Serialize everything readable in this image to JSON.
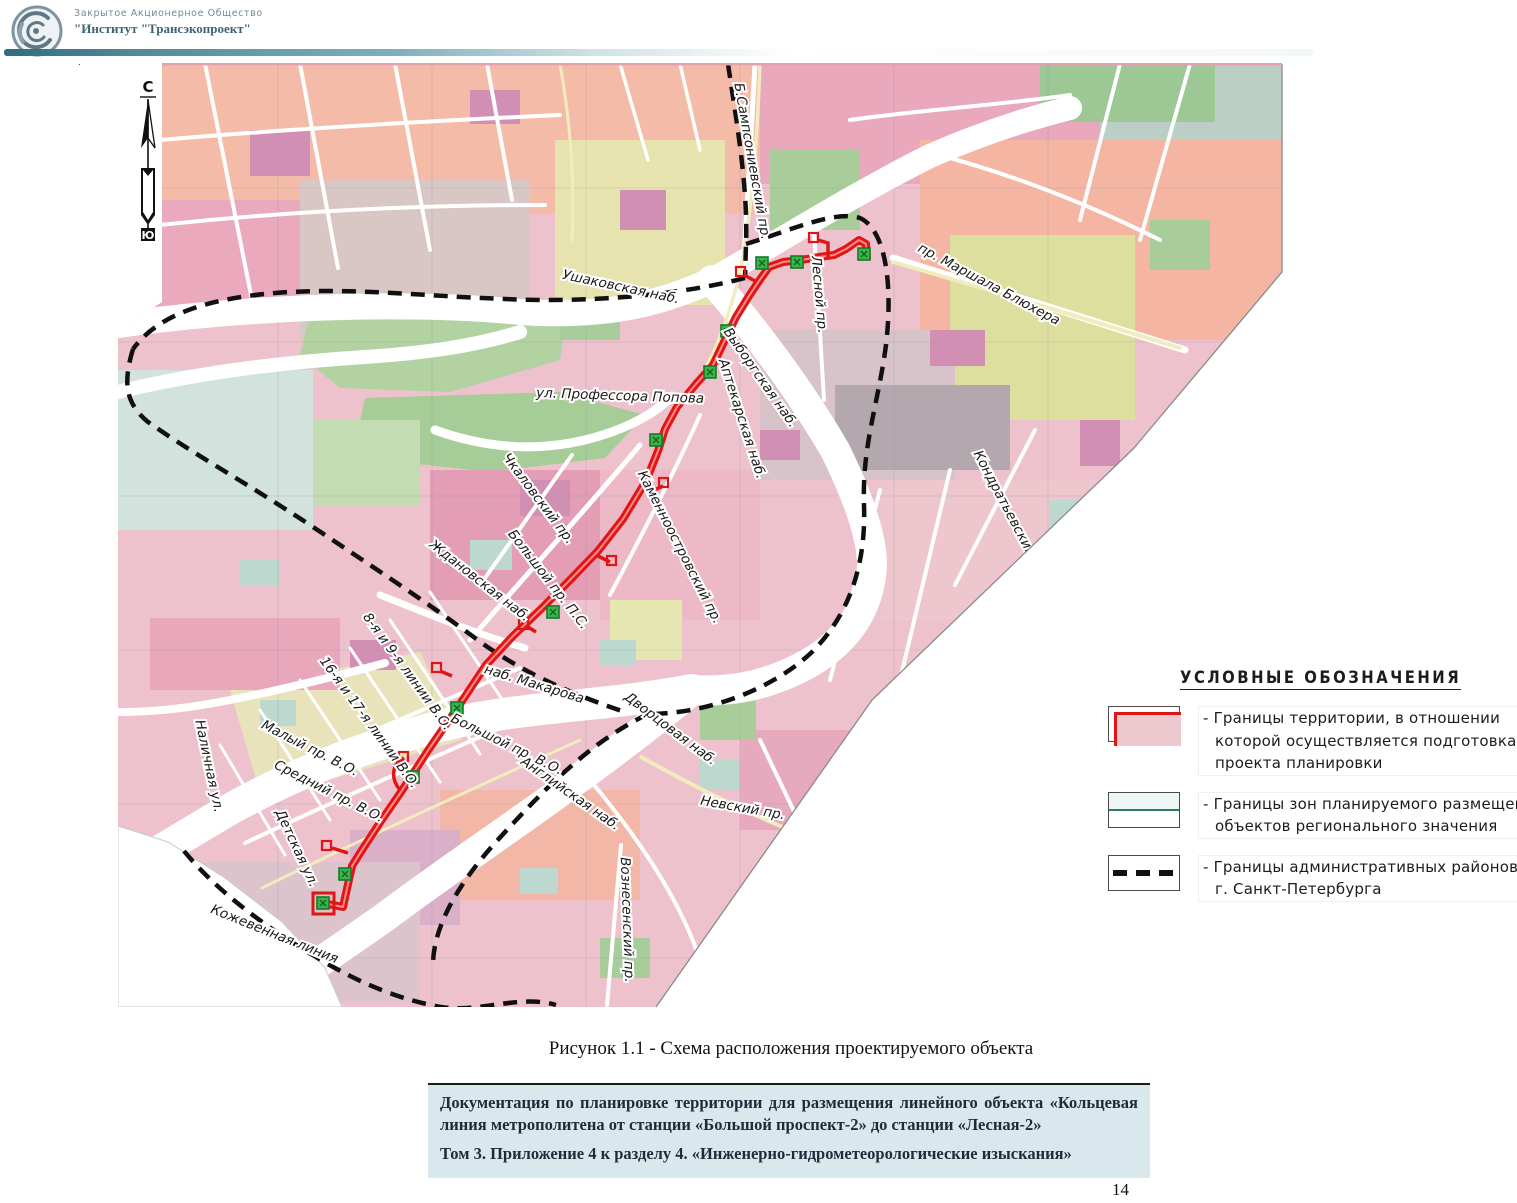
{
  "header": {
    "org_line1": "Закрытое Акционерное Общество",
    "org_line2": "\"Институт \"Трансэкопроект\"",
    "accent_color": "#4f8b99"
  },
  "page": {
    "number": "14",
    "background": "#ffffff"
  },
  "figure": {
    "caption": "Рисунок 1.1 - Схема расположения проектируемого объекта"
  },
  "footer_box": {
    "line1": "Документация по планировке территории для размещения линейного объекта «Кольцевая линия метрополитена от станции «Большой проспект-2» до станции «Лесная-2»",
    "line2": "Том 3. Приложение 4 к разделу 4. «Инженерно-гидрометеорологические изыскания»"
  },
  "legend": {
    "title": "УСЛОВНЫЕ ОБОЗНАЧЕНИЯ",
    "items": [
      {
        "swatch": "area-red",
        "lines": [
          "- Границы территории, в отношении",
          "которой осуществляется подготовка",
          "проекта планировки"
        ]
      },
      {
        "swatch": "line-teal",
        "lines": [
          "- Границы зон планируемого размещения",
          "объектов регионального значения"
        ]
      },
      {
        "swatch": "line-dashed",
        "lines": [
          "- Границы административных районов",
          "г. Санкт-Петербурга"
        ]
      }
    ]
  },
  "map": {
    "compass": {
      "north": "С",
      "south": "Ю"
    },
    "route_color": "#e01616",
    "station_color": "#3cb44b",
    "boundary_color": "#101010",
    "water_color": "#ffffff",
    "labels": [
      {
        "t": "Ушаковская наб.",
        "x": 620,
        "y": 291,
        "r": 12
      },
      {
        "t": "Б.Сампсониевский пр.",
        "x": 748,
        "y": 162,
        "r": 80
      },
      {
        "t": "пр. Маршала Блюхера",
        "x": 987,
        "y": 288,
        "r": 28
      },
      {
        "t": "Лесной пр.",
        "x": 815,
        "y": 295,
        "r": 85
      },
      {
        "t": "Выборгская наб.",
        "x": 757,
        "y": 380,
        "r": 55
      },
      {
        "t": "Аптекарская наб.",
        "x": 738,
        "y": 420,
        "r": 72
      },
      {
        "t": "ул. Профессора Попова",
        "x": 620,
        "y": 400,
        "r": 2
      },
      {
        "t": "Чкаловский пр.",
        "x": 535,
        "y": 501,
        "r": 53
      },
      {
        "t": "Каменноостровский пр.",
        "x": 676,
        "y": 549,
        "r": 63
      },
      {
        "t": "Ждановская наб.",
        "x": 477,
        "y": 584,
        "r": 38
      },
      {
        "t": "Большой пр. П.С.",
        "x": 545,
        "y": 582,
        "r": 52
      },
      {
        "t": "наб. Макарова",
        "x": 533,
        "y": 688,
        "r": 17
      },
      {
        "t": "8-я и 9-я линии В.О.",
        "x": 404,
        "y": 674,
        "r": 54
      },
      {
        "t": "16-я и 17-я линии В.О.",
        "x": 366,
        "y": 725,
        "r": 54
      },
      {
        "t": "Малый пр. В.О.",
        "x": 308,
        "y": 752,
        "r": 27
      },
      {
        "t": "Большой пр. В.О.",
        "x": 505,
        "y": 748,
        "r": 26
      },
      {
        "t": "Средний пр. В.О.",
        "x": 327,
        "y": 795,
        "r": 27
      },
      {
        "t": "Наличная ул.",
        "x": 205,
        "y": 767,
        "r": 78
      },
      {
        "t": "Детская ул.",
        "x": 293,
        "y": 850,
        "r": 65
      },
      {
        "t": "Дворцовая наб.",
        "x": 668,
        "y": 732,
        "r": 37
      },
      {
        "t": "Английская наб.",
        "x": 568,
        "y": 797,
        "r": 35
      },
      {
        "t": "Невский пр.",
        "x": 742,
        "y": 812,
        "r": 10
      },
      {
        "t": "Вознесенский пр.",
        "x": 623,
        "y": 920,
        "r": 88
      },
      {
        "t": "Кондратьевский пр.",
        "x": 1007,
        "y": 517,
        "r": 62
      },
      {
        "t": "Кожевенная линия",
        "x": 273,
        "y": 938,
        "r": 22
      }
    ]
  }
}
